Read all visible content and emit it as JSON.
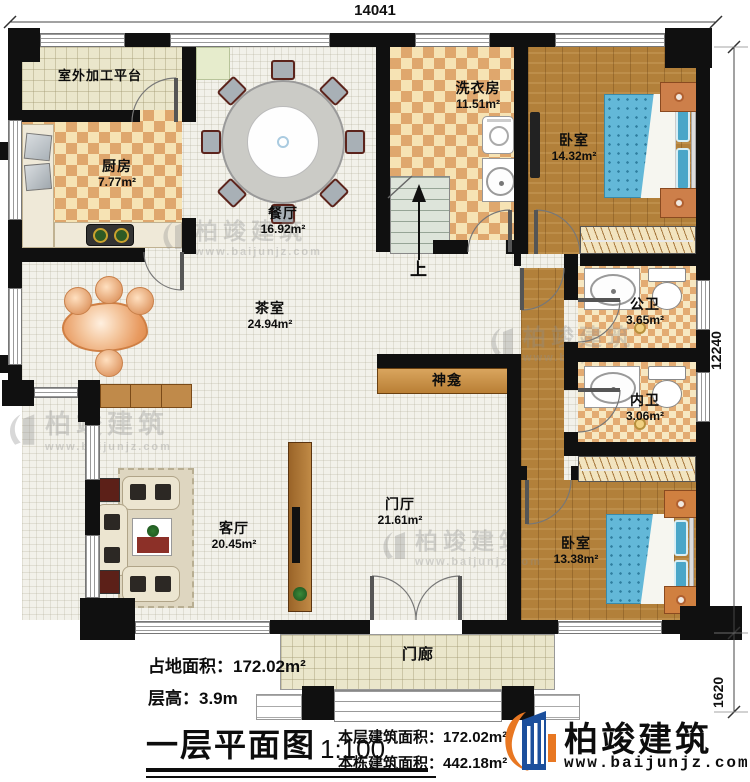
{
  "plan_title": "一层平面图",
  "scale": "1:100",
  "dimensions": {
    "top_width": "14041",
    "right_height": "12240",
    "porch_depth": "1620"
  },
  "rooms": {
    "platform": {
      "name": "室外加工平台"
    },
    "kitchen": {
      "name": "厨房",
      "area": "7.77m²"
    },
    "dining": {
      "name": "餐厅",
      "area": "16.92m²"
    },
    "laundry": {
      "name": "洗衣房",
      "area": "11.51m²"
    },
    "bedroom1": {
      "name": "卧室",
      "area": "14.32m²"
    },
    "tea_room": {
      "name": "茶室",
      "area": "24.94m²"
    },
    "public_bath": {
      "name": "公卫",
      "area": "3.65m²"
    },
    "private_bath": {
      "name": "内卫",
      "area": "3.06m²"
    },
    "shrine": {
      "name": "神龛"
    },
    "foyer": {
      "name": "门厅",
      "area": "21.61m²"
    },
    "living_room": {
      "name": "客厅",
      "area": "20.45m²"
    },
    "bedroom2": {
      "name": "卧室",
      "area": "13.38m²"
    },
    "porch": {
      "name": "门廊"
    }
  },
  "stairs": {
    "up_label": "上"
  },
  "footer": {
    "land_area_label": "占地面积：",
    "land_area_value": "172.02m²",
    "floor_height_label": "层高：",
    "floor_height_value": "3.9m",
    "floor_area_label": "本层建筑面积：",
    "floor_area_value": "172.02m²",
    "total_area_label": "本栋建筑面积：",
    "total_area_value": "442.18m²"
  },
  "brand": {
    "name": "柏竣建筑",
    "website": "www.baijunjz.com"
  },
  "watermark": {
    "name": "柏竣建筑",
    "website": "www.baijunjz.com"
  },
  "colors": {
    "wall": "#101010",
    "wood_floor": "#b2803a",
    "checker_tan": "#dfa76d",
    "checker_cream": "#f6e3b4",
    "bed_blue": "#63b8d8",
    "brand_blue": "#1c4f9c",
    "brand_orange": "#e87722"
  }
}
